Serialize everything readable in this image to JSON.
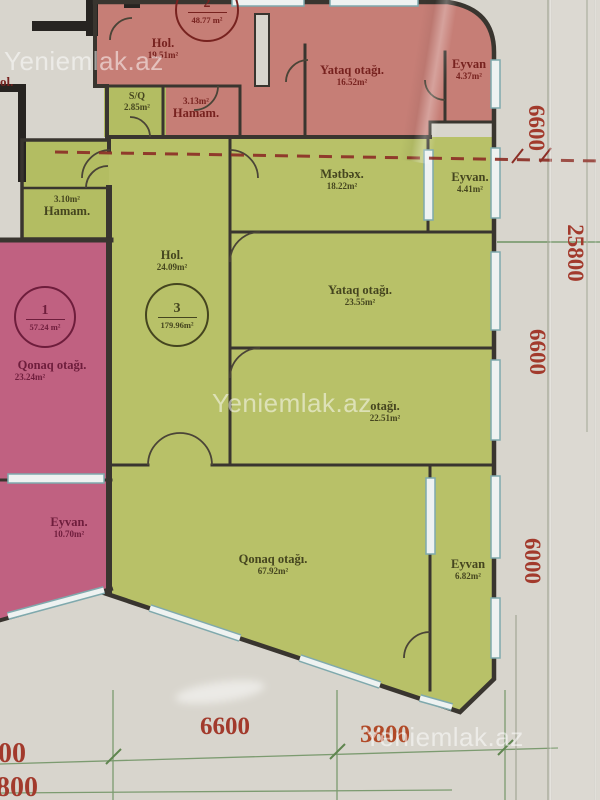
{
  "watermark": "Yeniemlak.az",
  "apartments": {
    "apt1": {
      "number": "1",
      "area": "57.24 m²"
    },
    "apt2": {
      "number": "2",
      "area": "48.77 m²"
    },
    "apt3": {
      "number": "3",
      "area": "179.96m²"
    }
  },
  "rooms": {
    "hol2": {
      "name": "Hol.",
      "area": "19.51m²"
    },
    "yataq2": {
      "name": "Yataq otağı.",
      "area": "16.52m²"
    },
    "eyvan2": {
      "name": "Eyvan",
      "area": "4.37m²"
    },
    "hamam2": {
      "name": "Hamam.",
      "area": "3.13m²"
    },
    "sq": {
      "name": "S/Q",
      "area": "2.85m²"
    },
    "metbex": {
      "name": "Mətbəx.",
      "area": "18.22m²"
    },
    "eyvan3_top": {
      "name": "Eyvan.",
      "area": "4.41m²"
    },
    "hamam3": {
      "name": "Hamam.",
      "area": "3.10m²"
    },
    "hol3": {
      "name": "Hol.",
      "area": "24.09m²"
    },
    "yataq3": {
      "name": "Yataq otağı.",
      "area": "23.55m²"
    },
    "otaq3": {
      "name": "otağı.",
      "area": "22.51m²"
    },
    "qonaq3": {
      "name": "Qonaq otağı.",
      "area": "67.92m²"
    },
    "eyvan3_bottom": {
      "name": "Eyvan",
      "area": "6.82m²"
    },
    "qonaq1": {
      "name": "Qonaq otağı.",
      "area": "23.24m²"
    },
    "eyvan1": {
      "name": "Eyvan.",
      "area": "10.70m²"
    },
    "neighbor": {
      "name": "ol."
    }
  },
  "dimensions": {
    "right": [
      "6600",
      "25800",
      "6600",
      "6000"
    ],
    "bottom": [
      "6600",
      "3800"
    ],
    "left_cut": [
      "00",
      "800"
    ]
  }
}
